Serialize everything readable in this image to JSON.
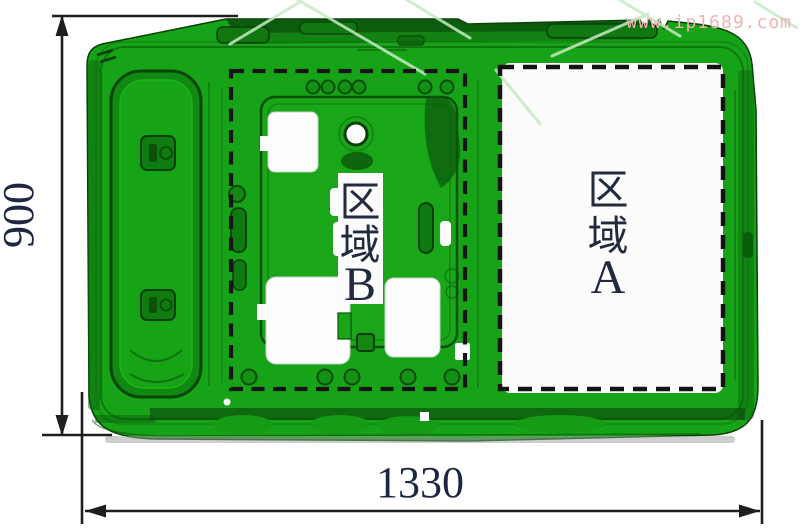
{
  "watermark": {
    "text": "www.ip1689.com"
  },
  "dimensions": {
    "height": {
      "value": "900"
    },
    "width": {
      "value": "1330"
    }
  },
  "regions": {
    "a": {
      "label_lines": [
        "区",
        "域",
        "A"
      ]
    },
    "b": {
      "label_lines": [
        "区",
        "域",
        "B"
      ]
    }
  },
  "colors": {
    "panel_green": "#17a317",
    "panel_dark_green": "#0a4f0a",
    "cutout_white": "#fcfdfc",
    "dashed_border": "#141414",
    "dimension_line": "#1e1e1e",
    "label_text": "#222b3e",
    "watermark_text_pink": "#f0b2b2",
    "watermark_line_green": "#c6eac4",
    "background": "#ffffff"
  }
}
